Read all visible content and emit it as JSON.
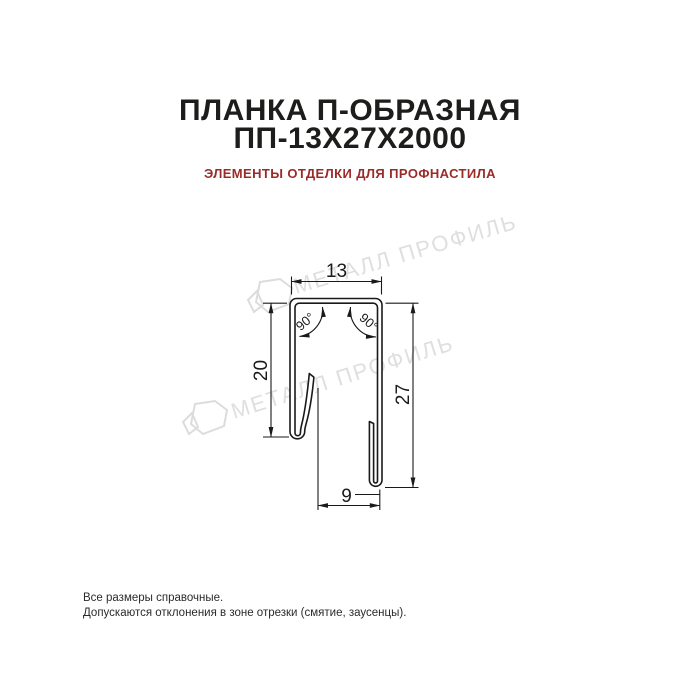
{
  "header": {
    "title_line1": "ПЛАНКА П-ОБРАЗНАЯ",
    "title_line2": "ПП-13Х27Х2000",
    "subtitle": "ЭЛЕМЕНТЫ ОТДЕЛКИ ДЛЯ ПРОФНАСТИЛА"
  },
  "drawing": {
    "dimensions": {
      "top_width_mm": "13",
      "left_height_mm": "20",
      "right_height_mm": "27",
      "bottom_width_mm": "9",
      "angle_left": "90°",
      "angle_right": "90°"
    }
  },
  "watermark": {
    "text": "МЕТАЛЛ ПРОФИЛЬ"
  },
  "footer": {
    "line1": "Все размеры справочные.",
    "line2": "Допускаются отклонения в зоне отрезки (смятие, заусенцы)."
  },
  "colors": {
    "ink": "#1a1a1a",
    "accent_red": "#9b2b28",
    "watermark_gray": "#dfdfdf"
  }
}
